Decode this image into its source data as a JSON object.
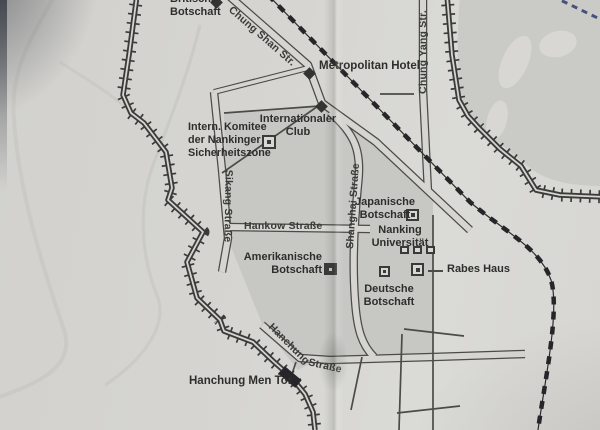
{
  "map": {
    "title": "Karte der Nankinger Sicherheitszone",
    "labels": {
      "britische_botschaft": {
        "line1": "Britische",
        "line2": "Botschaft"
      },
      "metropolitan_hotel": {
        "text": "Metropolitan Hotel"
      },
      "internationaler_club": {
        "line1": "Internationaler",
        "line2": "Club"
      },
      "komitee": {
        "line1": "Intern. Komitee",
        "line2": "der Nankinger",
        "line3": "Sicherheitszone"
      },
      "japanische_botschaft": {
        "line1": "Japanische",
        "line2": "Botschaft"
      },
      "nanking_universitaet": {
        "line1": "Nanking",
        "line2": "Universität"
      },
      "amerikanische_botschaft": {
        "line1": "Amerikanische",
        "line2": "Botschaft"
      },
      "rabes_haus": {
        "text": "Rabes Haus"
      },
      "deutsche_botschaft": {
        "line1": "Deutsche",
        "line2": "Botschaft"
      },
      "hanchung_men_tor": {
        "text": "Hanchung Men Tor"
      }
    },
    "streets": {
      "chung_shan": "Chung Shan Str.",
      "chung_yang": "Chung Yang Str.",
      "sikang": "Sikang Straße",
      "hankow": "Hankow Straße",
      "shanghai": "Shanghai Straße",
      "hanchung_part1": "Hanchung",
      "hanchung_part2": "Straße"
    },
    "colors": {
      "paper": "#d6d5d1",
      "zone_gray": "#c7c7c4",
      "terrain_gray": "#cacac7",
      "ink": "#3b3b39",
      "railroad": "#26262a",
      "water": "#c9cac5",
      "corner_rail_blue": "#47517a"
    }
  }
}
